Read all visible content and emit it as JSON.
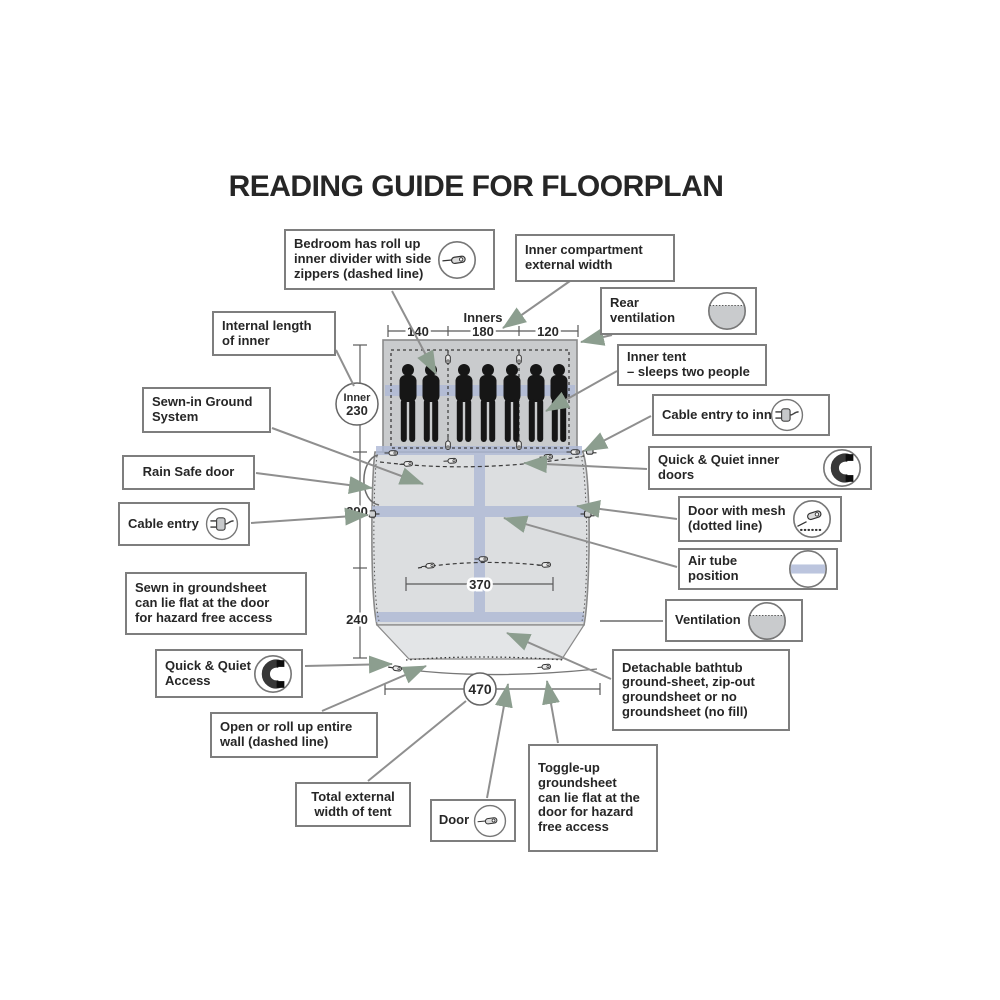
{
  "title": "READING GUIDE FOR FLOORPLAN",
  "callouts": {
    "bedroom_divider": "Bedroom has roll up\ninner divider with side\nzippers (dashed line)",
    "inner_compartment": "Inner compartment\nexternal width",
    "rear_ventilation": "Rear ventilation",
    "internal_length": "Internal length\nof inner",
    "inner_tent": "Inner tent\n– sleeps two people",
    "sewn_ground_system": "Sewn-in Ground\nSystem",
    "cable_entry_inner": "Cable entry to inn",
    "rain_safe_door": "Rain Safe door",
    "qq_inner_doors": "Quick & Quiet inner doors",
    "cable_entry": "Cable entry",
    "door_mesh": "Door with mesh\n(dotted line)",
    "air_tube": "Air tube position",
    "sewn_groundsheet": "Sewn in groundsheet\ncan lie flat at the door\nfor hazard free access",
    "ventilation": "Ventilation",
    "qq_access": "Quick & Quiet\nAccess",
    "detachable_groundsheet": "Detachable bathtub\nground-sheet, zip-out\ngroundsheet or no\ngroundsheet (no fill)",
    "open_roll_wall": "Open or roll up entire\nwall (dashed line)",
    "toggle_up": "Toggle-up\ngroundsheet\ncan lie flat at the\ndoor for hazard\nfree access",
    "total_width": "Total external\nwidth of tent",
    "door": "Door"
  },
  "measurements": {
    "inners_label": "Inners",
    "width_left": "140",
    "width_mid": "180",
    "width_right": "120",
    "inner_label": "Inner",
    "inner_length": "230",
    "living_length": "290",
    "front_length": "240",
    "door_width": "370",
    "total_width": "470"
  },
  "icons": {
    "zipper": "zipper-icon",
    "zipper_mesh": "zipper-mesh-icon",
    "vent": "ventilation-icon",
    "plug": "cable-plug-icon",
    "magnet": "magnet-icon",
    "air_tube": "air-tube-icon"
  },
  "colors": {
    "arrow": "#8C9E8F",
    "connector_line": "#8f8f8f",
    "box_border": "#7e7e7e",
    "tent_fill": "#dcdee0",
    "bedroom_fill": "#c9cbcd",
    "front_fill": "#e3e5e7",
    "air_tube_band": "#aeb9d6",
    "silhouette": "#161616",
    "text": "#262626"
  }
}
